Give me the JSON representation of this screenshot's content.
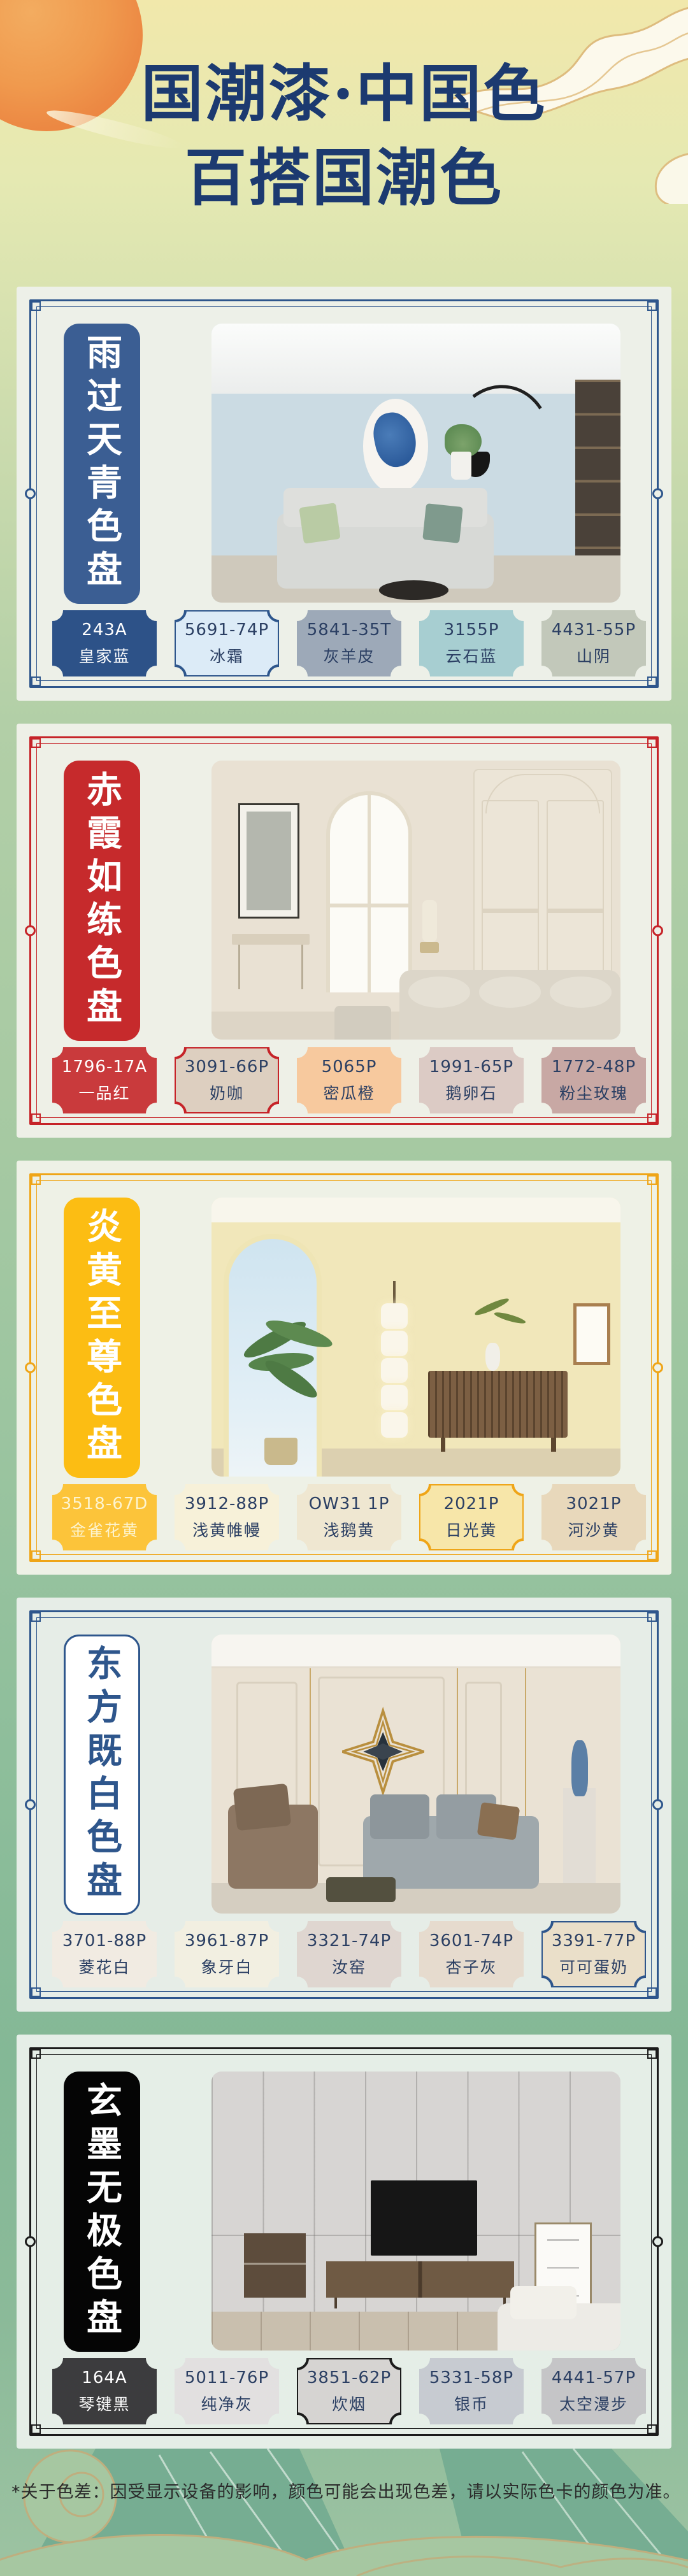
{
  "header": {
    "title_line1": "国潮漆·中国色",
    "title_line2": "百搭国潮色",
    "title_color": "#1c3a70"
  },
  "sections": [
    {
      "tab": "雨过天青色盘",
      "accent": "#2e568c",
      "tab_bg": "#3b5e93",
      "tab_text": "#ffffff",
      "tab_border": "",
      "card_bg": "#edf0e8",
      "wall": "#cbdbe3",
      "swatches": [
        {
          "code": "243A",
          "name": "皇家蓝",
          "fill": "#2d5288",
          "text": "#ffffff",
          "border": ""
        },
        {
          "code": "5691-74P",
          "name": "冰霜",
          "fill": "#dcebf7",
          "text": "#2b3f63",
          "border": "#2e568c"
        },
        {
          "code": "5841-35T",
          "name": "灰羊皮",
          "fill": "#9da9b8",
          "text": "#2b3f63",
          "border": ""
        },
        {
          "code": "3155P",
          "name": "云石蓝",
          "fill": "#a7ced1",
          "text": "#2b3f63",
          "border": ""
        },
        {
          "code": "4431-55P",
          "name": "山阴",
          "fill": "#c2c8ba",
          "text": "#2b3f63",
          "border": ""
        }
      ]
    },
    {
      "tab": "赤霞如练色盘",
      "accent": "#c62328",
      "tab_bg": "#c62a2c",
      "tab_text": "#ffffff",
      "tab_border": "",
      "card_bg": "#eef0e7",
      "wall": "#e9e1d3",
      "swatches": [
        {
          "code": "1796-17A",
          "name": "一品红",
          "fill": "#c93a3c",
          "text": "#ffffff",
          "border": ""
        },
        {
          "code": "3091-66P",
          "name": "奶咖",
          "fill": "#ddcfc0",
          "text": "#2b3f63",
          "border": "#c62328"
        },
        {
          "code": "5065P",
          "name": "密瓜橙",
          "fill": "#f7c99e",
          "text": "#2b3f63",
          "border": ""
        },
        {
          "code": "1991-65P",
          "name": "鹅卵石",
          "fill": "#dccbc5",
          "text": "#2b3f63",
          "border": ""
        },
        {
          "code": "1772-48P",
          "name": "粉尘玫瑰",
          "fill": "#c8a8a4",
          "text": "#2b3f63",
          "border": ""
        }
      ]
    },
    {
      "tab": "炎黄至尊色盘",
      "accent": "#efa517",
      "tab_bg": "#fcbd13",
      "tab_text": "#ffffff",
      "tab_border": "",
      "card_bg": "#eef1e6",
      "wall": "#f1e7ba",
      "swatches": [
        {
          "code": "3518-67D",
          "name": "金雀花黄",
          "fill": "#fcc43a",
          "text": "#fdf4cf",
          "border": ""
        },
        {
          "code": "3912-88P",
          "name": "浅黄帷幔",
          "fill": "#f7f1d9",
          "text": "#2b3f63",
          "border": ""
        },
        {
          "code": "OW31 1P",
          "name": "浅鹅黄",
          "fill": "#efe7d1",
          "text": "#2b3f63",
          "border": ""
        },
        {
          "code": "2021P",
          "name": "日光黄",
          "fill": "#f7e6a9",
          "text": "#2b3f63",
          "border": "#efa517"
        },
        {
          "code": "3021P",
          "name": "河沙黄",
          "fill": "#e8d8bb",
          "text": "#2b3f63",
          "border": ""
        }
      ]
    },
    {
      "tab": "东方既白色盘",
      "accent": "#2e568c",
      "tab_bg": "#ffffff",
      "tab_text": "#2e568c",
      "tab_border": "#2e568c",
      "card_bg": "#e6ede7",
      "wall": "#eae2d4",
      "swatches": [
        {
          "code": "3701-88P",
          "name": "菱花白",
          "fill": "#f1ebe2",
          "text": "#2b3f63",
          "border": ""
        },
        {
          "code": "3961-87P",
          "name": "象牙白",
          "fill": "#f2efe1",
          "text": "#2b3f63",
          "border": ""
        },
        {
          "code": "3321-74P",
          "name": "汝窑",
          "fill": "#dfd6d0",
          "text": "#2b3f63",
          "border": ""
        },
        {
          "code": "3601-74P",
          "name": "杏子灰",
          "fill": "#e6dbce",
          "text": "#2b3f63",
          "border": ""
        },
        {
          "code": "3391-77P",
          "name": "可可蛋奶",
          "fill": "#eadfc9",
          "text": "#2b3f63",
          "border": "#2e568c"
        }
      ]
    },
    {
      "tab": "玄墨无极色盘",
      "accent": "#1b1b1b",
      "tab_bg": "#050505",
      "tab_text": "#ffffff",
      "tab_border": "",
      "card_bg": "#e5eee7",
      "wall": "#d7d5d3",
      "swatches": [
        {
          "code": "164A",
          "name": "琴键黑",
          "fill": "#3c3c3e",
          "text": "#ffffff",
          "border": ""
        },
        {
          "code": "5011-76P",
          "name": "纯净灰",
          "fill": "#e2e0e0",
          "text": "#2b3f63",
          "border": ""
        },
        {
          "code": "3851-62P",
          "name": "炊烟",
          "fill": "#d6d4d2",
          "text": "#2b3f63",
          "border": "#1b1b1b"
        },
        {
          "code": "5331-58P",
          "name": "银币",
          "fill": "#c7cbd1",
          "text": "#2b3f63",
          "border": ""
        },
        {
          "code": "4441-57P",
          "name": "太空漫步",
          "fill": "#c5c5c7",
          "text": "#2b3f63",
          "border": ""
        }
      ]
    }
  ],
  "footer": {
    "note": "*关于色差：因受显示设备的影响，颜色可能会出现色差，请以实际色卡的颜色为准。"
  }
}
